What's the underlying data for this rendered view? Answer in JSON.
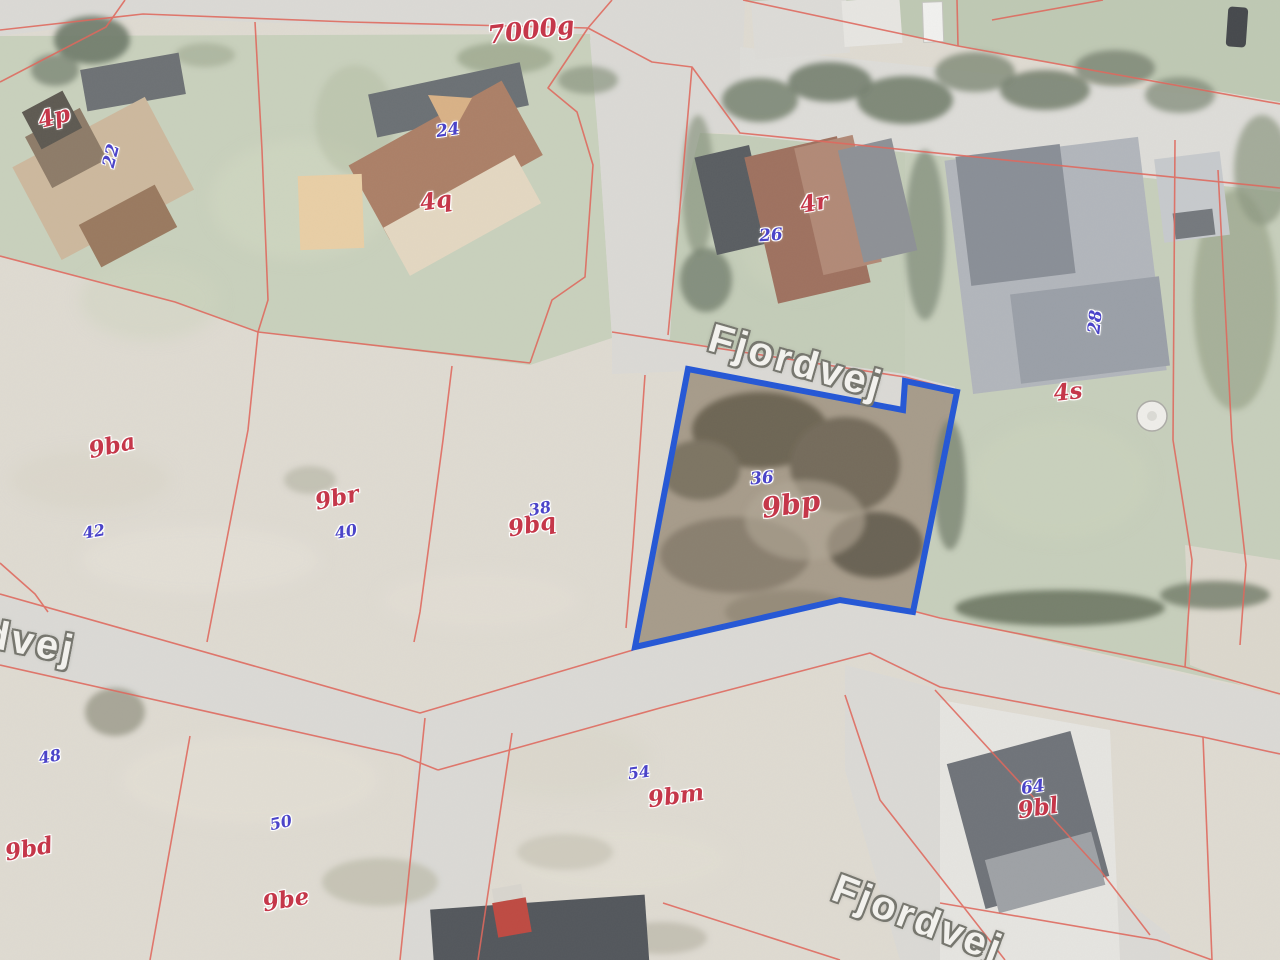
{
  "map": {
    "type": "cadastral-orthophoto",
    "street_labels": {
      "top": "Fjordvej",
      "bottom": "Fjordvej",
      "west_partial": "dvej"
    },
    "road_parcel_label": "7000g",
    "parcels": {
      "p4p": "4p",
      "p4q": "4q",
      "p4r": "4r",
      "p4s": "4s",
      "p9ba": "9ba",
      "p9br": "9br",
      "p9bq": "9bq",
      "p9bp": "9bp",
      "p9bd": "9bd",
      "p9be": "9be",
      "p9bm": "9bm",
      "p9bl": "9bl"
    },
    "house_numbers": {
      "n22": "22",
      "n24": "24",
      "n26": "26",
      "n28": "28",
      "n36": "36",
      "n38": "38",
      "n40": "40",
      "n42": "42",
      "n48": "48",
      "n50": "50",
      "n54": "54",
      "n64": "64"
    },
    "highlighted_parcel": {
      "parcel_label": "9bp",
      "house_number": "36",
      "outline_color": "#2457d6"
    },
    "colors": {
      "cadastral_line": "#e0675c",
      "parcel_label_text": "#c5374a",
      "house_number_text": "#4b44c9",
      "street_label_text": "#f2f1ed"
    }
  }
}
